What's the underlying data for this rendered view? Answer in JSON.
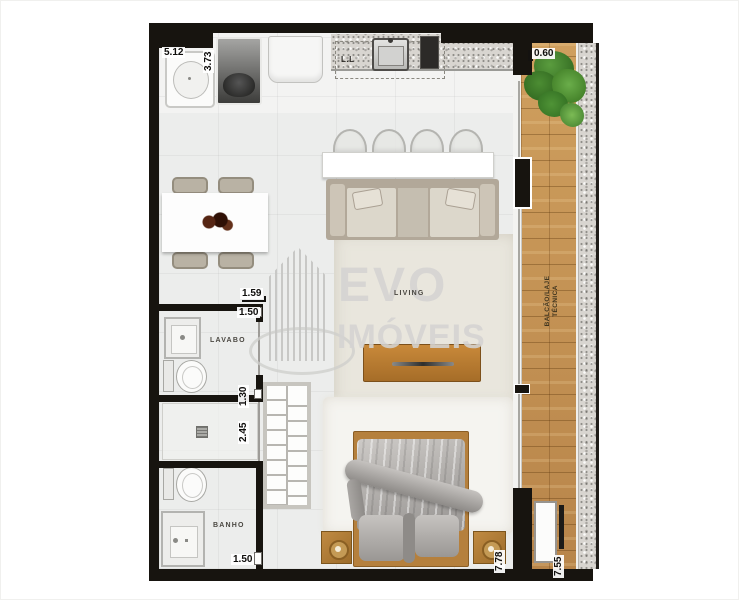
{
  "watermark": {
    "line1": "EVO",
    "line2": "IMÓVEIS"
  },
  "labels": {
    "living": "LIVING",
    "lavabo": "LAVABO",
    "banho": "BANHO",
    "balcony_line1": "BALCÃO/LAJE",
    "balcony_line2": "TÉCNICA",
    "counter": "L.L"
  },
  "dimensions": {
    "laundry_width": "5.12",
    "kitchen_side": "3.73",
    "balcony_width": "0.60",
    "dining_width": "1.59",
    "lavabo_width": "1.50",
    "lavabo_depth": "1.30",
    "shower_depth": "2.45",
    "banho_width": "1.50",
    "unit_depth": "7.78",
    "balcony_depth": "7.55"
  },
  "colors": {
    "wall": "#17140f",
    "deck": "#c2914f",
    "wood": "#b5803d",
    "floor": "#eeefee",
    "green": "#3f7d2c"
  }
}
